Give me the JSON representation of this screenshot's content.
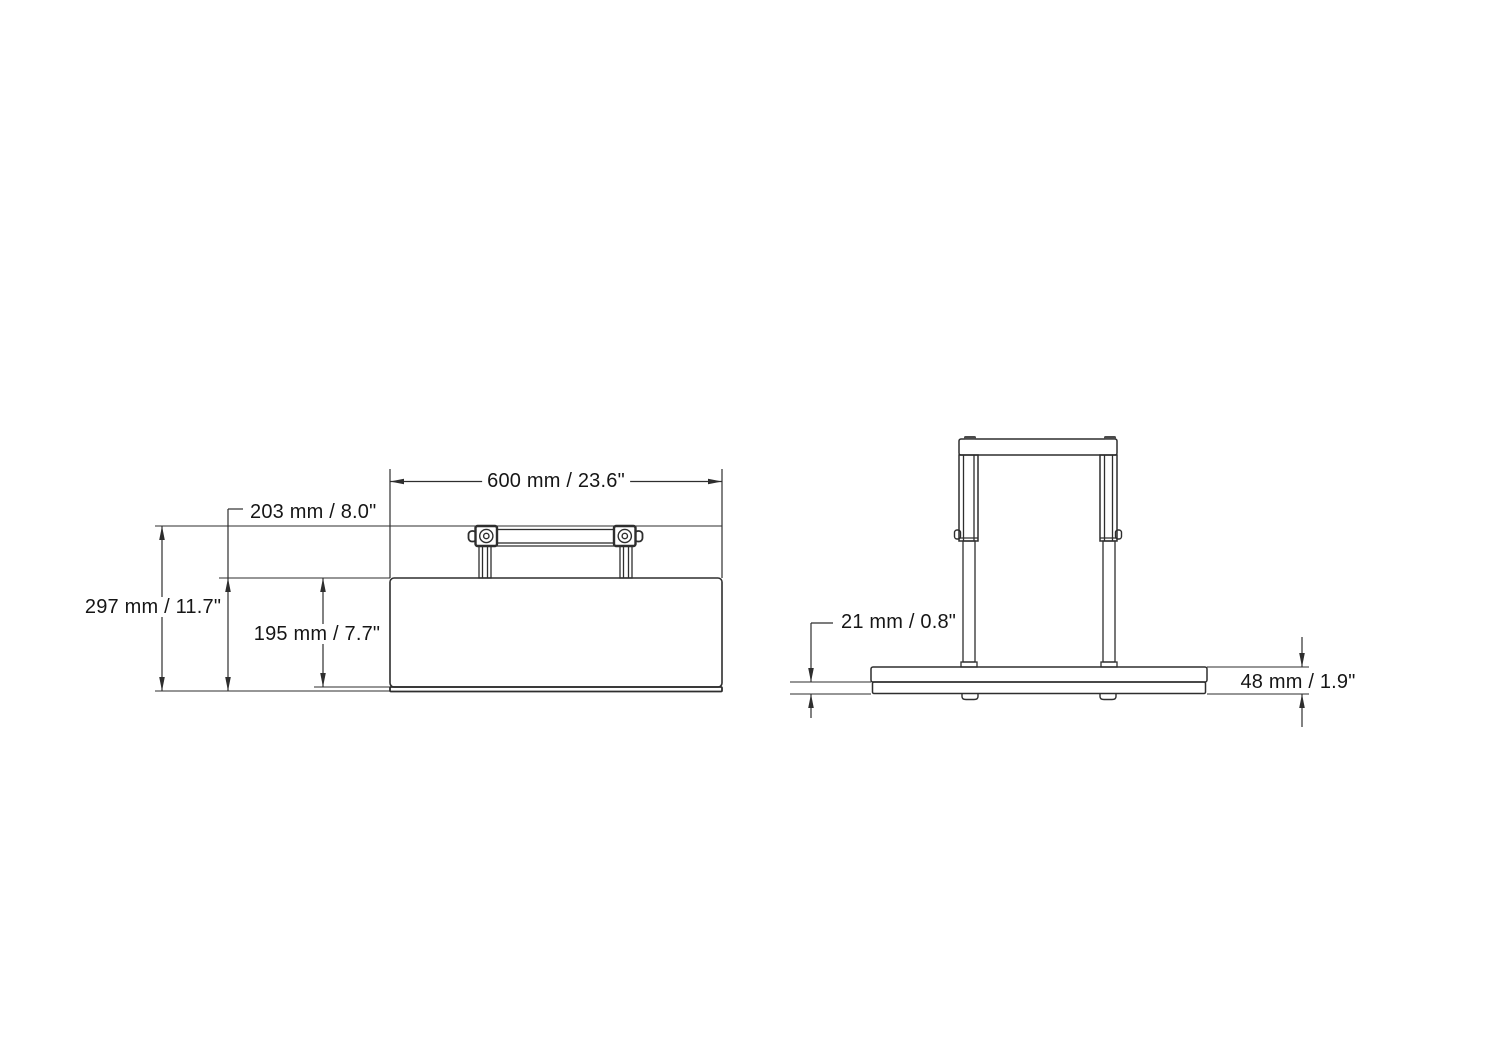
{
  "drawing": {
    "type": "technical-dimension-drawing",
    "background_color": "#ffffff",
    "line_color": "#2e2e2e",
    "text_color": "#161616",
    "views": {
      "front_view": {
        "description": "flat press body with folded carry handle on top and thin base lip",
        "dimensions": {
          "overall_width": "600 mm / 23.6\"",
          "overall_height": "297 mm / 11.7\"",
          "height_with_base_lip": "203 mm / 8.0\"",
          "body_height": "195 mm / 7.7\""
        }
      },
      "side_view": {
        "description": "side profile with raised handle frame over base plate",
        "dimensions": {
          "base_pad_thickness": "21 mm / 0.8\"",
          "base_total_thickness": "48 mm / 1.9\""
        }
      }
    }
  }
}
